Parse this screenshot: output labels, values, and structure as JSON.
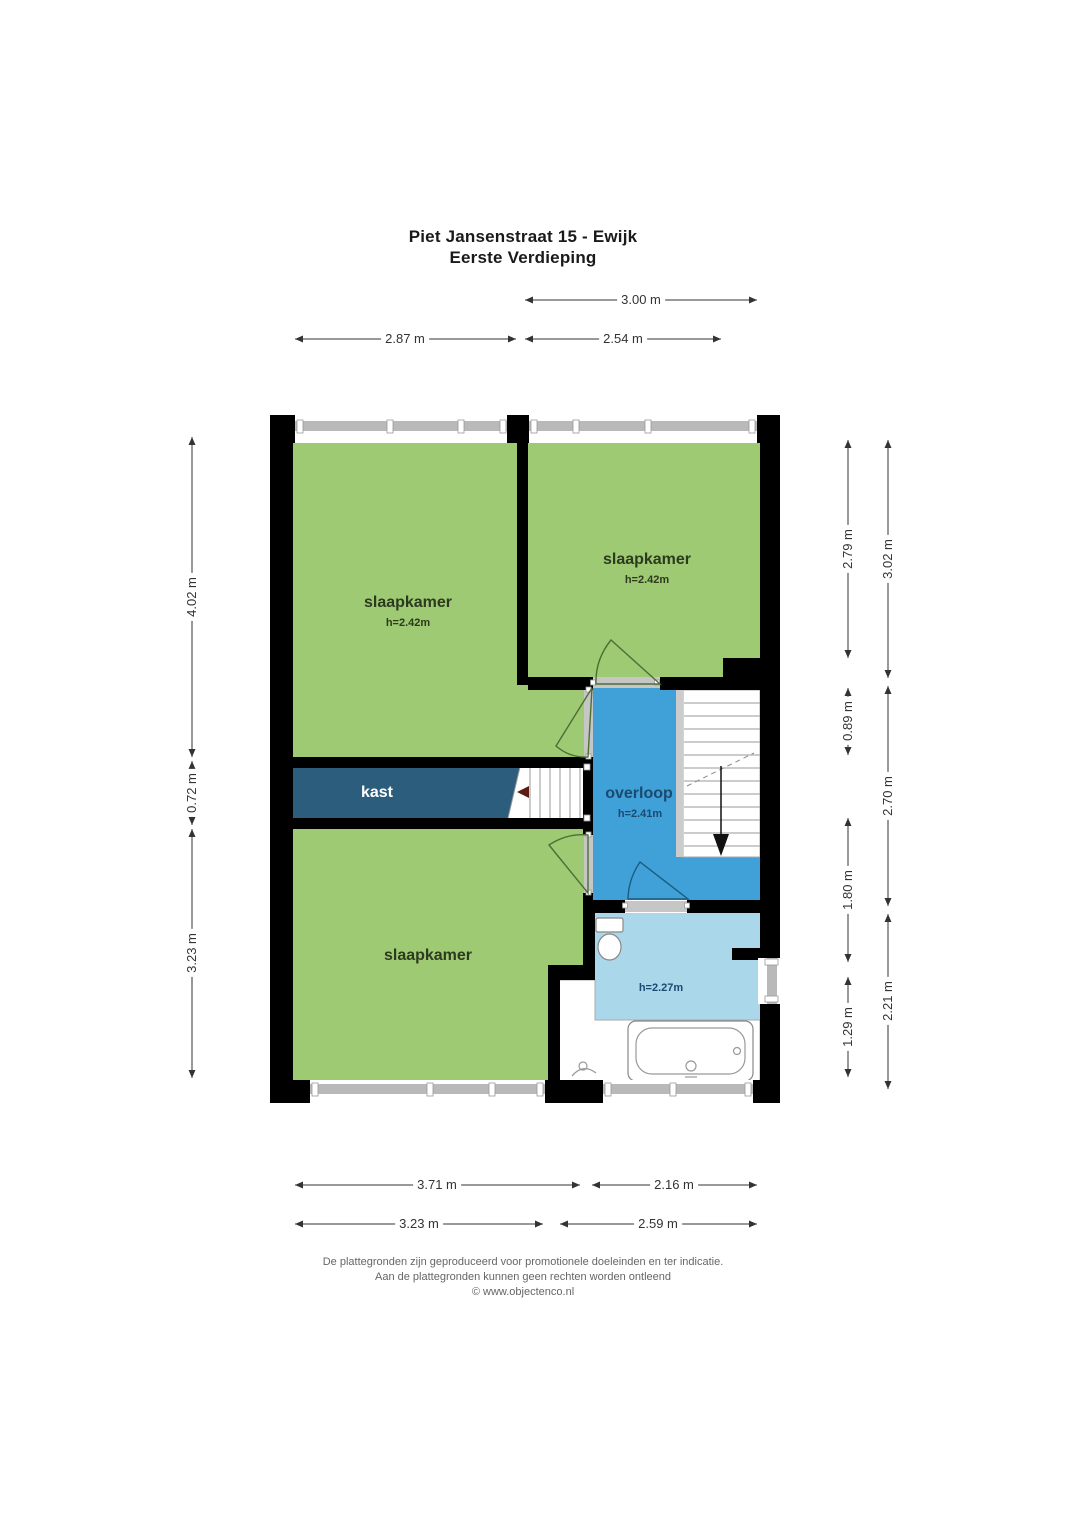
{
  "title": {
    "line1": "Piet Jansenstraat 15 - Ewijk",
    "line2": "Eerste Verdieping"
  },
  "rooms": {
    "bedroom_top_left": {
      "label": "slaapkamer",
      "ceiling": "h=2.42m"
    },
    "bedroom_top_right": {
      "label": "slaapkamer",
      "ceiling": "h=2.42m"
    },
    "bedroom_bottom": {
      "label": "slaapkamer"
    },
    "closet": {
      "label": "kast"
    },
    "landing": {
      "label": "overloop",
      "ceiling": "h=2.41m"
    },
    "bathroom": {
      "ceiling": "h=2.27m"
    }
  },
  "dimensions": {
    "top_section": "3.00 m",
    "top_left": "2.87 m",
    "top_right": "2.54 m",
    "left_top": "4.02 m",
    "left_middle": "0.72 m",
    "left_bottom": "3.23 m",
    "right_inner_top": "2.79 m",
    "right_inner_stairs": "0.89 m",
    "right_inner_landing": "1.80 m",
    "right_inner_bath": "1.29 m",
    "right_outer_top": "3.02 m",
    "right_outer_middle": "2.70 m",
    "right_outer_bottom": "2.21 m",
    "bottom_inner_left": "3.71 m",
    "bottom_inner_right": "2.16 m",
    "bottom_outer_left": "3.23 m",
    "bottom_outer_right": "2.59 m"
  },
  "footer": {
    "line1": "De plattegronden zijn geproduceerd voor promotionele doeleinden en ter indicatie.",
    "line2": "Aan de plattegronden kunnen geen rechten worden ontleend",
    "line3": "© www.objectenco.nl"
  },
  "colors": {
    "wall": "#000000",
    "bedroom_green": "#9dca72",
    "closet_blue": "#2d5d7d",
    "landing_blue": "#3fa1d8",
    "bathroom_blue": "#abd7eb",
    "door_arc_green": "#4e6e33",
    "door_arc_blue": "#1d5a7d",
    "dimension": "#333333",
    "label_dark": "#2d3a20",
    "label_blue": "#1a4a70",
    "footer_text": "#666666"
  }
}
